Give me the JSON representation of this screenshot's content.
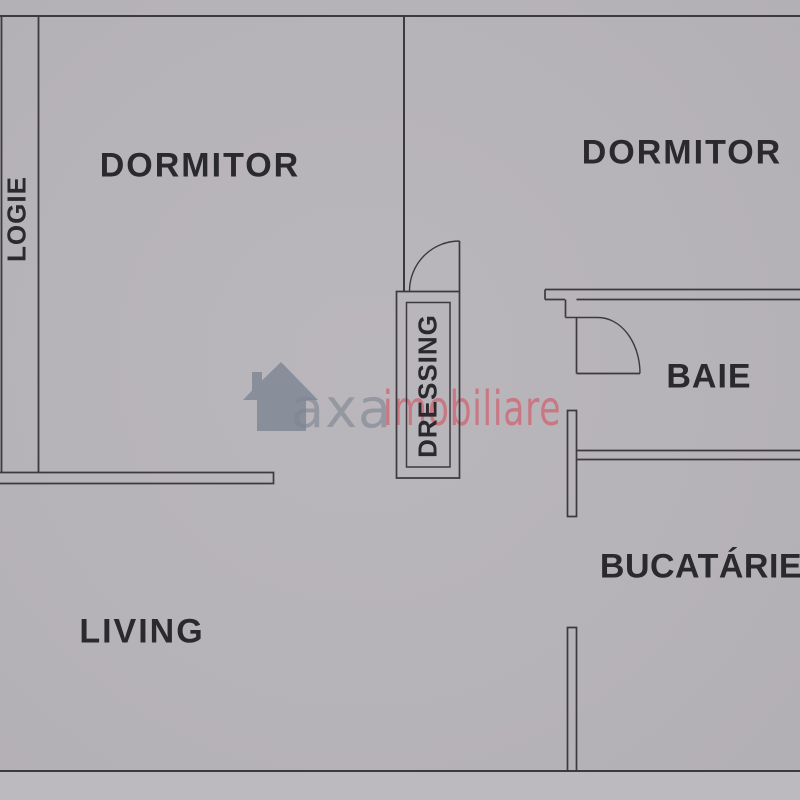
{
  "plan_title": "apartment-floor-plan",
  "colors": {
    "background": "#b7b4b9",
    "wall_line": "#3c3a3e",
    "label_text": "#2a292d",
    "watermark_gray": "#7e8694",
    "watermark_red": "#ca6d79"
  },
  "rooms": [
    {
      "id": "dormitor-left",
      "label": "DORMITOR"
    },
    {
      "id": "dormitor-right",
      "label": "DORMITOR"
    },
    {
      "id": "logie",
      "label": "LOGIE"
    },
    {
      "id": "dressing",
      "label": "DRESSING"
    },
    {
      "id": "baie",
      "label": "BAIE"
    },
    {
      "id": "bucatarie",
      "label": "BUCATÁRIE"
    },
    {
      "id": "living",
      "label": "LIVING"
    }
  ],
  "watermark": {
    "primary_text": "axa",
    "secondary_text": "imobiliare",
    "house_icon": "house-icon"
  }
}
